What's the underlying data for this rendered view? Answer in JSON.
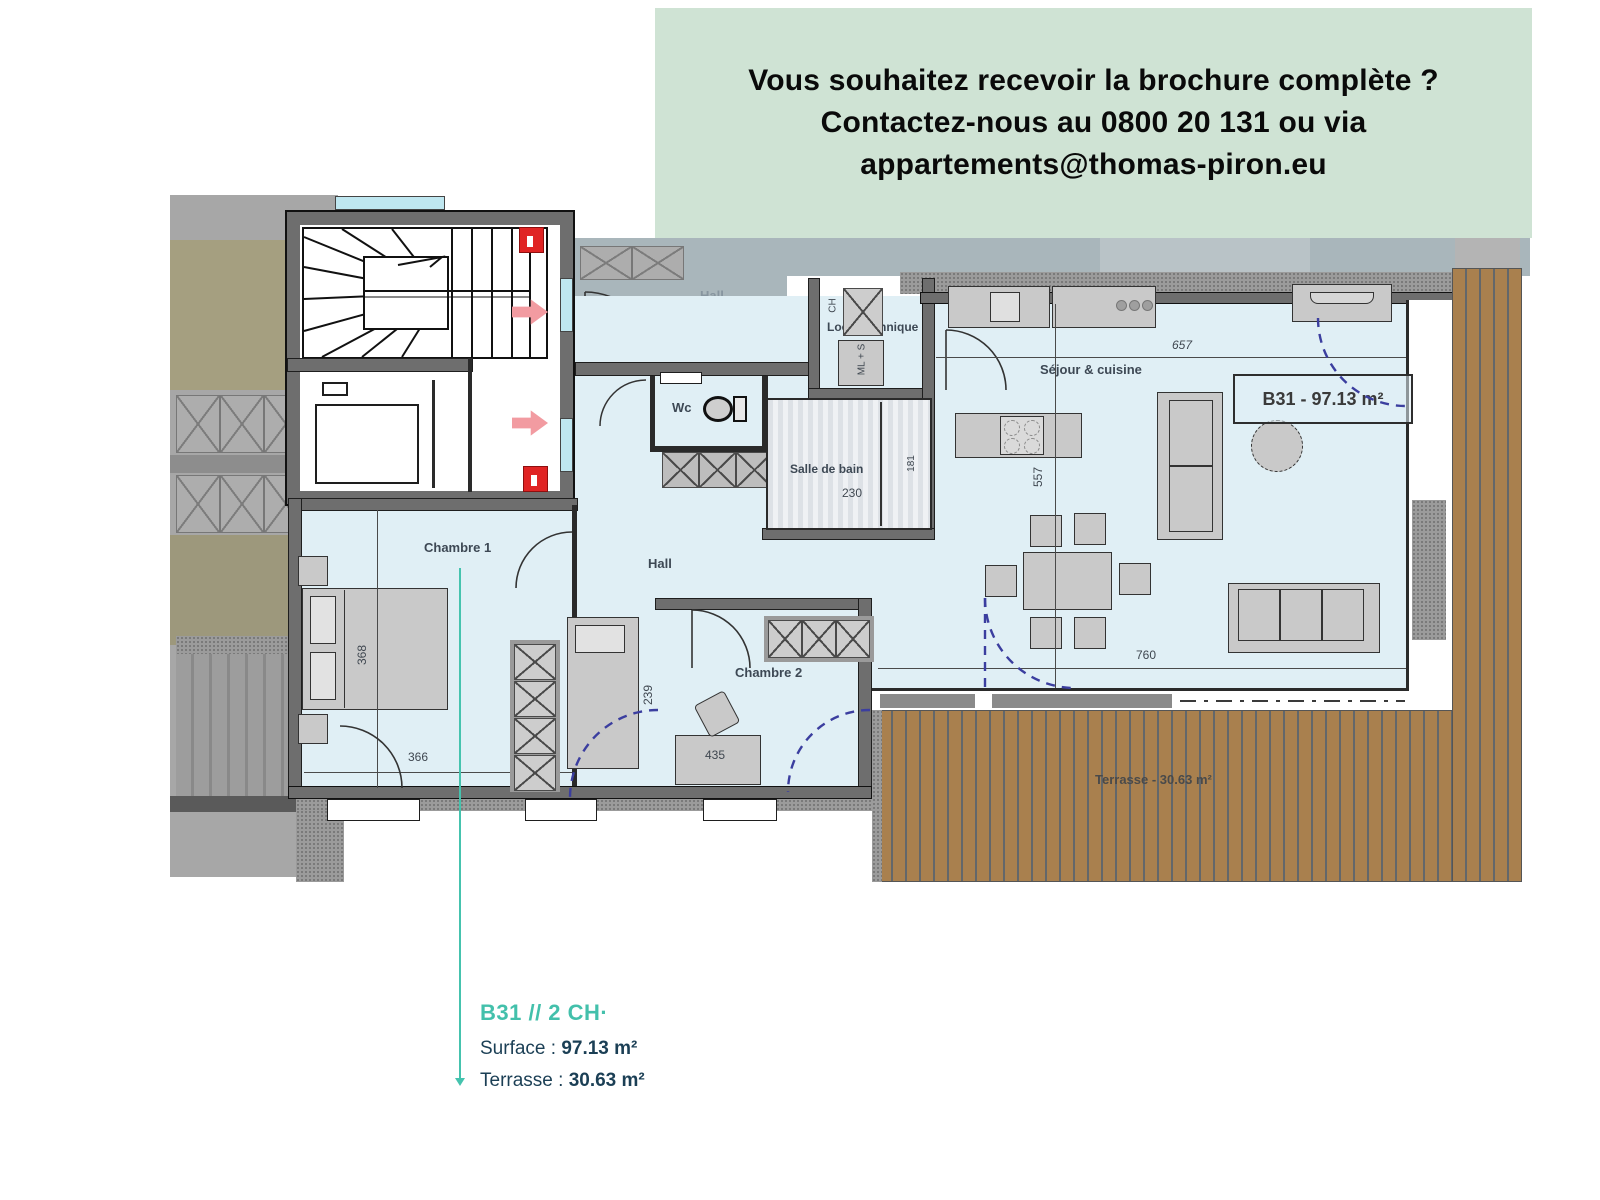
{
  "banner": {
    "line1": "Vous souhaitez recevoir la brochure complète ?",
    "line2": "Contactez-nous au 0800 20 131 ou via",
    "line3": "appartements@thomas-piron.eu",
    "bg_color": "#cfe3d4",
    "text_color": "#0a0a0a"
  },
  "plan": {
    "labels": {
      "common_hall": "Hall",
      "local_technique": "Local technique",
      "wc": "Wc",
      "salle_de_bain": "Salle de bain",
      "hall": "Hall",
      "sejour": "Séjour & cuisine",
      "chambre1": "Chambre 1",
      "chambre2": "Chambre 2",
      "terrasse": "Terrasse - 30.63 m²",
      "unit_box": "B31 - 97.13 m²"
    },
    "appliances": {
      "ch": "CH",
      "ml_s": "ML + S"
    },
    "dims": {
      "d657": "657",
      "d557": "557",
      "d760": "760",
      "d230": "230",
      "d181": "181",
      "d368": "368",
      "d366": "366",
      "d239": "239",
      "d435": "435"
    },
    "colors": {
      "floor": "#e0eff5",
      "wall": "#6e6e6e",
      "wood": "#a9804e",
      "dimmed_zone": "#a9b6bb",
      "door_swing_dashed": "#3b3e9f",
      "safety_red": "#e02424",
      "arrow_pink": "#f29ba1"
    }
  },
  "footer": {
    "title": "B31 // 2 CH·",
    "surface_label": "Surface :",
    "surface_value": "97.13 m²",
    "terrasse_label": "Terrasse :",
    "terrasse_value": "30.63 m²",
    "accent_color": "#43c0ab",
    "text_color": "#1b3f55"
  }
}
